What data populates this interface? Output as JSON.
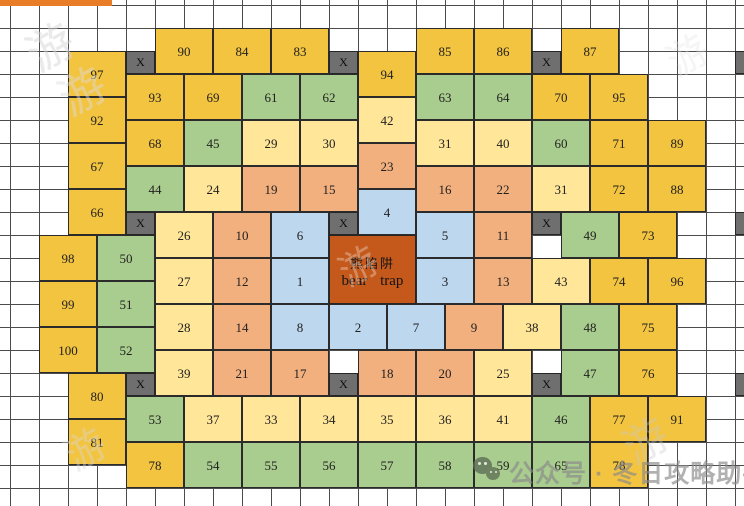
{
  "canvas": {
    "width": 744,
    "height": 506,
    "unit_w": 29,
    "unit_h": 23,
    "origin_x": 10,
    "origin_y": 5
  },
  "colors": {
    "gold": "#F3C440",
    "cream": "#FFE699",
    "salmon": "#F2B07E",
    "green": "#A9CD8E",
    "blue": "#BDD7EE",
    "trap": "#C4591B",
    "gray_x": "#6F6F6F",
    "grid_line": "#4C4C4C",
    "cell_border": "#2B2B2B",
    "top_bar": "#E97C26"
  },
  "bear_trap": {
    "k": 11,
    "r": 10,
    "kw": 3,
    "rh": 3,
    "label_cn": "熊陷阱",
    "label_en": "bear trap"
  },
  "x_label": "X",
  "x_marks": [
    {
      "k": 4,
      "r": 2
    },
    {
      "k": 11,
      "r": 2
    },
    {
      "k": 18,
      "r": 2
    },
    {
      "k": 25,
      "r": 2
    },
    {
      "k": 4,
      "r": 9
    },
    {
      "k": 11,
      "r": 9
    },
    {
      "k": 18,
      "r": 9
    },
    {
      "k": 25,
      "r": 9
    },
    {
      "k": 4,
      "r": 16
    },
    {
      "k": 11,
      "r": 16
    },
    {
      "k": 18,
      "r": 16
    },
    {
      "k": 25,
      "r": 16
    }
  ],
  "cells": [
    {
      "n": "90",
      "k": 5,
      "r": 1,
      "c": "gold"
    },
    {
      "n": "84",
      "k": 7,
      "r": 1,
      "c": "gold"
    },
    {
      "n": "83",
      "k": 9,
      "r": 1,
      "c": "gold"
    },
    {
      "n": "85",
      "k": 14,
      "r": 1,
      "c": "gold"
    },
    {
      "n": "86",
      "k": 16,
      "r": 1,
      "c": "gold"
    },
    {
      "n": "87",
      "k": 19,
      "r": 1,
      "c": "gold"
    },
    {
      "n": "97",
      "k": 2,
      "r": 2,
      "c": "gold"
    },
    {
      "n": "94",
      "k": 12,
      "r": 2,
      "c": "gold"
    },
    {
      "n": "93",
      "k": 4,
      "r": 3,
      "c": "gold"
    },
    {
      "n": "69",
      "k": 6,
      "r": 3,
      "c": "gold"
    },
    {
      "n": "61",
      "k": 8,
      "r": 3,
      "c": "green"
    },
    {
      "n": "62",
      "k": 10,
      "r": 3,
      "c": "green"
    },
    {
      "n": "63",
      "k": 14,
      "r": 3,
      "c": "green"
    },
    {
      "n": "64",
      "k": 16,
      "r": 3,
      "c": "green"
    },
    {
      "n": "70",
      "k": 18,
      "r": 3,
      "c": "gold"
    },
    {
      "n": "95",
      "k": 20,
      "r": 3,
      "c": "gold"
    },
    {
      "n": "92",
      "k": 2,
      "r": 4,
      "c": "gold"
    },
    {
      "n": "42",
      "k": 12,
      "r": 4,
      "c": "cream"
    },
    {
      "n": "68",
      "k": 4,
      "r": 5,
      "c": "gold"
    },
    {
      "n": "45",
      "k": 6,
      "r": 5,
      "c": "green"
    },
    {
      "n": "29",
      "k": 8,
      "r": 5,
      "c": "cream"
    },
    {
      "n": "30",
      "k": 10,
      "r": 5,
      "c": "cream"
    },
    {
      "n": "31",
      "k": 14,
      "r": 5,
      "c": "cream"
    },
    {
      "n": "40",
      "k": 16,
      "r": 5,
      "c": "cream"
    },
    {
      "n": "60",
      "k": 18,
      "r": 5,
      "c": "green"
    },
    {
      "n": "71",
      "k": 20,
      "r": 5,
      "c": "gold"
    },
    {
      "n": "89",
      "k": 22,
      "r": 5,
      "c": "gold"
    },
    {
      "n": "67",
      "k": 2,
      "r": 6,
      "c": "gold"
    },
    {
      "n": "23",
      "k": 12,
      "r": 6,
      "c": "salmon"
    },
    {
      "n": "44",
      "k": 4,
      "r": 7,
      "c": "green"
    },
    {
      "n": "24",
      "k": 6,
      "r": 7,
      "c": "cream"
    },
    {
      "n": "19",
      "k": 8,
      "r": 7,
      "c": "salmon"
    },
    {
      "n": "15",
      "k": 10,
      "r": 7,
      "c": "salmon"
    },
    {
      "n": "16",
      "k": 14,
      "r": 7,
      "c": "salmon"
    },
    {
      "n": "22",
      "k": 16,
      "r": 7,
      "c": "salmon"
    },
    {
      "n": "31",
      "k": 18,
      "r": 7,
      "c": "cream"
    },
    {
      "n": "72",
      "k": 20,
      "r": 7,
      "c": "gold"
    },
    {
      "n": "88",
      "k": 22,
      "r": 7,
      "c": "gold"
    },
    {
      "n": "66",
      "k": 2,
      "r": 8,
      "c": "gold"
    },
    {
      "n": "4",
      "k": 12,
      "r": 8,
      "c": "blue"
    },
    {
      "n": "26",
      "k": 5,
      "r": 9,
      "c": "cream"
    },
    {
      "n": "10",
      "k": 7,
      "r": 9,
      "c": "salmon"
    },
    {
      "n": "6",
      "k": 9,
      "r": 9,
      "c": "blue"
    },
    {
      "n": "5",
      "k": 14,
      "r": 9,
      "c": "blue"
    },
    {
      "n": "11",
      "k": 16,
      "r": 9,
      "c": "salmon"
    },
    {
      "n": "49",
      "k": 19,
      "r": 9,
      "c": "green"
    },
    {
      "n": "73",
      "k": 21,
      "r": 9,
      "c": "gold"
    },
    {
      "n": "98",
      "k": 1,
      "r": 10,
      "c": "gold"
    },
    {
      "n": "50",
      "k": 3,
      "r": 10,
      "c": "green"
    },
    {
      "n": "27",
      "k": 5,
      "r": 11,
      "c": "cream"
    },
    {
      "n": "12",
      "k": 7,
      "r": 11,
      "c": "salmon"
    },
    {
      "n": "1",
      "k": 9,
      "r": 11,
      "c": "blue"
    },
    {
      "n": "3",
      "k": 14,
      "r": 11,
      "c": "blue"
    },
    {
      "n": "13",
      "k": 16,
      "r": 11,
      "c": "salmon"
    },
    {
      "n": "43",
      "k": 18,
      "r": 11,
      "c": "cream"
    },
    {
      "n": "74",
      "k": 20,
      "r": 11,
      "c": "gold"
    },
    {
      "n": "96",
      "k": 22,
      "r": 11,
      "c": "gold"
    },
    {
      "n": "99",
      "k": 1,
      "r": 12,
      "c": "gold"
    },
    {
      "n": "51",
      "k": 3,
      "r": 12,
      "c": "green"
    },
    {
      "n": "28",
      "k": 5,
      "r": 13,
      "c": "cream"
    },
    {
      "n": "14",
      "k": 7,
      "r": 13,
      "c": "salmon"
    },
    {
      "n": "8",
      "k": 9,
      "r": 13,
      "c": "blue"
    },
    {
      "n": "2",
      "k": 11,
      "r": 13,
      "c": "blue"
    },
    {
      "n": "7",
      "k": 13,
      "r": 13,
      "c": "blue"
    },
    {
      "n": "9",
      "k": 15,
      "r": 13,
      "c": "salmon"
    },
    {
      "n": "38",
      "k": 17,
      "r": 13,
      "c": "cream"
    },
    {
      "n": "48",
      "k": 19,
      "r": 13,
      "c": "green"
    },
    {
      "n": "75",
      "k": 21,
      "r": 13,
      "c": "gold"
    },
    {
      "n": "100",
      "k": 1,
      "r": 14,
      "c": "gold"
    },
    {
      "n": "52",
      "k": 3,
      "r": 14,
      "c": "green"
    },
    {
      "n": "39",
      "k": 5,
      "r": 15,
      "c": "cream"
    },
    {
      "n": "21",
      "k": 7,
      "r": 15,
      "c": "salmon"
    },
    {
      "n": "17",
      "k": 9,
      "r": 15,
      "c": "salmon"
    },
    {
      "n": "18",
      "k": 12,
      "r": 15,
      "c": "salmon"
    },
    {
      "n": "20",
      "k": 14,
      "r": 15,
      "c": "salmon"
    },
    {
      "n": "25",
      "k": 16,
      "r": 15,
      "c": "cream"
    },
    {
      "n": "47",
      "k": 19,
      "r": 15,
      "c": "green"
    },
    {
      "n": "76",
      "k": 21,
      "r": 15,
      "c": "gold"
    },
    {
      "n": "80",
      "k": 2,
      "r": 16,
      "c": "gold"
    },
    {
      "n": "53",
      "k": 4,
      "r": 17,
      "c": "green"
    },
    {
      "n": "37",
      "k": 6,
      "r": 17,
      "c": "cream"
    },
    {
      "n": "33",
      "k": 8,
      "r": 17,
      "c": "cream"
    },
    {
      "n": "34",
      "k": 10,
      "r": 17,
      "c": "cream"
    },
    {
      "n": "35",
      "k": 12,
      "r": 17,
      "c": "cream"
    },
    {
      "n": "36",
      "k": 14,
      "r": 17,
      "c": "cream"
    },
    {
      "n": "41",
      "k": 16,
      "r": 17,
      "c": "cream"
    },
    {
      "n": "46",
      "k": 18,
      "r": 17,
      "c": "green"
    },
    {
      "n": "77",
      "k": 20,
      "r": 17,
      "c": "gold"
    },
    {
      "n": "91",
      "k": 22,
      "r": 17,
      "c": "gold"
    },
    {
      "n": "81",
      "k": 2,
      "r": 18,
      "c": "gold"
    },
    {
      "n": "78",
      "k": 4,
      "r": 19,
      "c": "gold"
    },
    {
      "n": "54",
      "k": 6,
      "r": 19,
      "c": "green"
    },
    {
      "n": "55",
      "k": 8,
      "r": 19,
      "c": "green"
    },
    {
      "n": "56",
      "k": 10,
      "r": 19,
      "c": "green"
    },
    {
      "n": "57",
      "k": 12,
      "r": 19,
      "c": "green"
    },
    {
      "n": "58",
      "k": 14,
      "r": 19,
      "c": "green"
    },
    {
      "n": "59",
      "k": 16,
      "r": 19,
      "c": "green"
    },
    {
      "n": "65",
      "k": 18,
      "r": 19,
      "c": "green"
    },
    {
      "n": "78",
      "k": 20,
      "r": 19,
      "c": "gold"
    }
  ],
  "brand": {
    "text": "公众号 · 冬日攻略助手",
    "icon": "wechat"
  },
  "watermarks": [
    {
      "glyph": "游",
      "x": 26,
      "y": 12,
      "size": 46,
      "rot": -30,
      "color": "#d7d7d7",
      "op": 0.5
    },
    {
      "glyph": "游",
      "x": 58,
      "y": 56,
      "size": 46,
      "rot": -30,
      "color": "#dcdcdc",
      "op": 0.45
    },
    {
      "glyph": "游",
      "x": 338,
      "y": 236,
      "size": 38,
      "rot": -30,
      "color": "#ffffff",
      "op": 0.3
    },
    {
      "glyph": "游",
      "x": 666,
      "y": 24,
      "size": 40,
      "rot": -30,
      "color": "#e4e4e4",
      "op": 0.35
    },
    {
      "glyph": "游",
      "x": 622,
      "y": 406,
      "size": 44,
      "rot": -30,
      "color": "#c9c9c9",
      "op": 0.35
    },
    {
      "glyph": "游",
      "x": 64,
      "y": 418,
      "size": 40,
      "rot": -30,
      "color": "#d9d9d9",
      "op": 0.4
    }
  ]
}
